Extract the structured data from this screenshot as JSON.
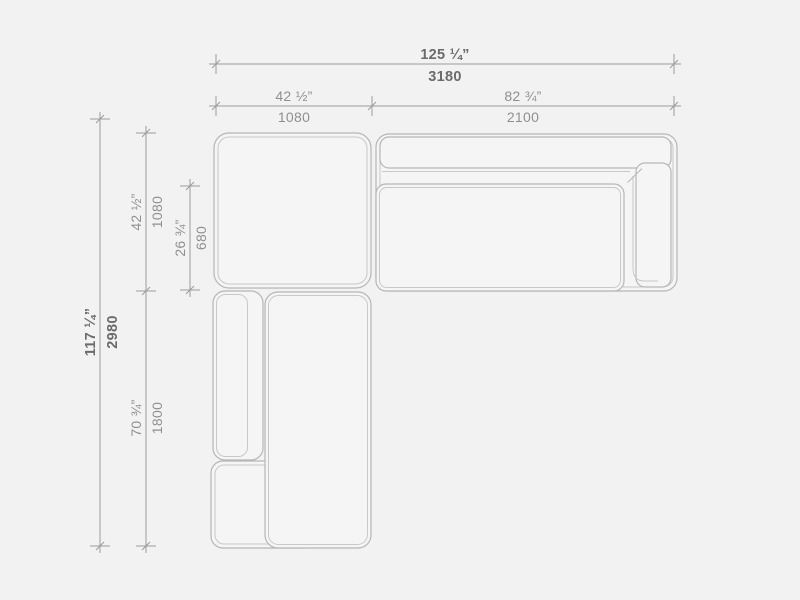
{
  "drawing": {
    "kind": "sectional-sofa-top-view-dimension-drawing",
    "dimensions": {
      "overall_width": {
        "inches": "125 ¼”",
        "mm": "3180"
      },
      "back_section_width": {
        "inches": "42 ½”",
        "mm": "1080"
      },
      "right_section_width": {
        "inches": "82 ¾”",
        "mm": "2100"
      },
      "overall_depth": {
        "inches": "117 ¼”",
        "mm": "2980"
      },
      "corner_section_depth": {
        "inches": "42 ½”",
        "mm": "1080"
      },
      "seat_depth": {
        "inches": "26 ¾”",
        "mm": "680"
      },
      "chaise_section_depth": {
        "inches": "70 ¾”",
        "mm": "1800"
      }
    }
  },
  "colors": {
    "background": "#f2f2f2",
    "module_fill": "#f5f5f5",
    "outline": "#b6b6b6",
    "inner_line": "#c8c8c8",
    "dim_line": "#9c9c9c",
    "dim_text_primary": "#6b6b6b",
    "dim_text_secondary": "#8f8f8f"
  }
}
